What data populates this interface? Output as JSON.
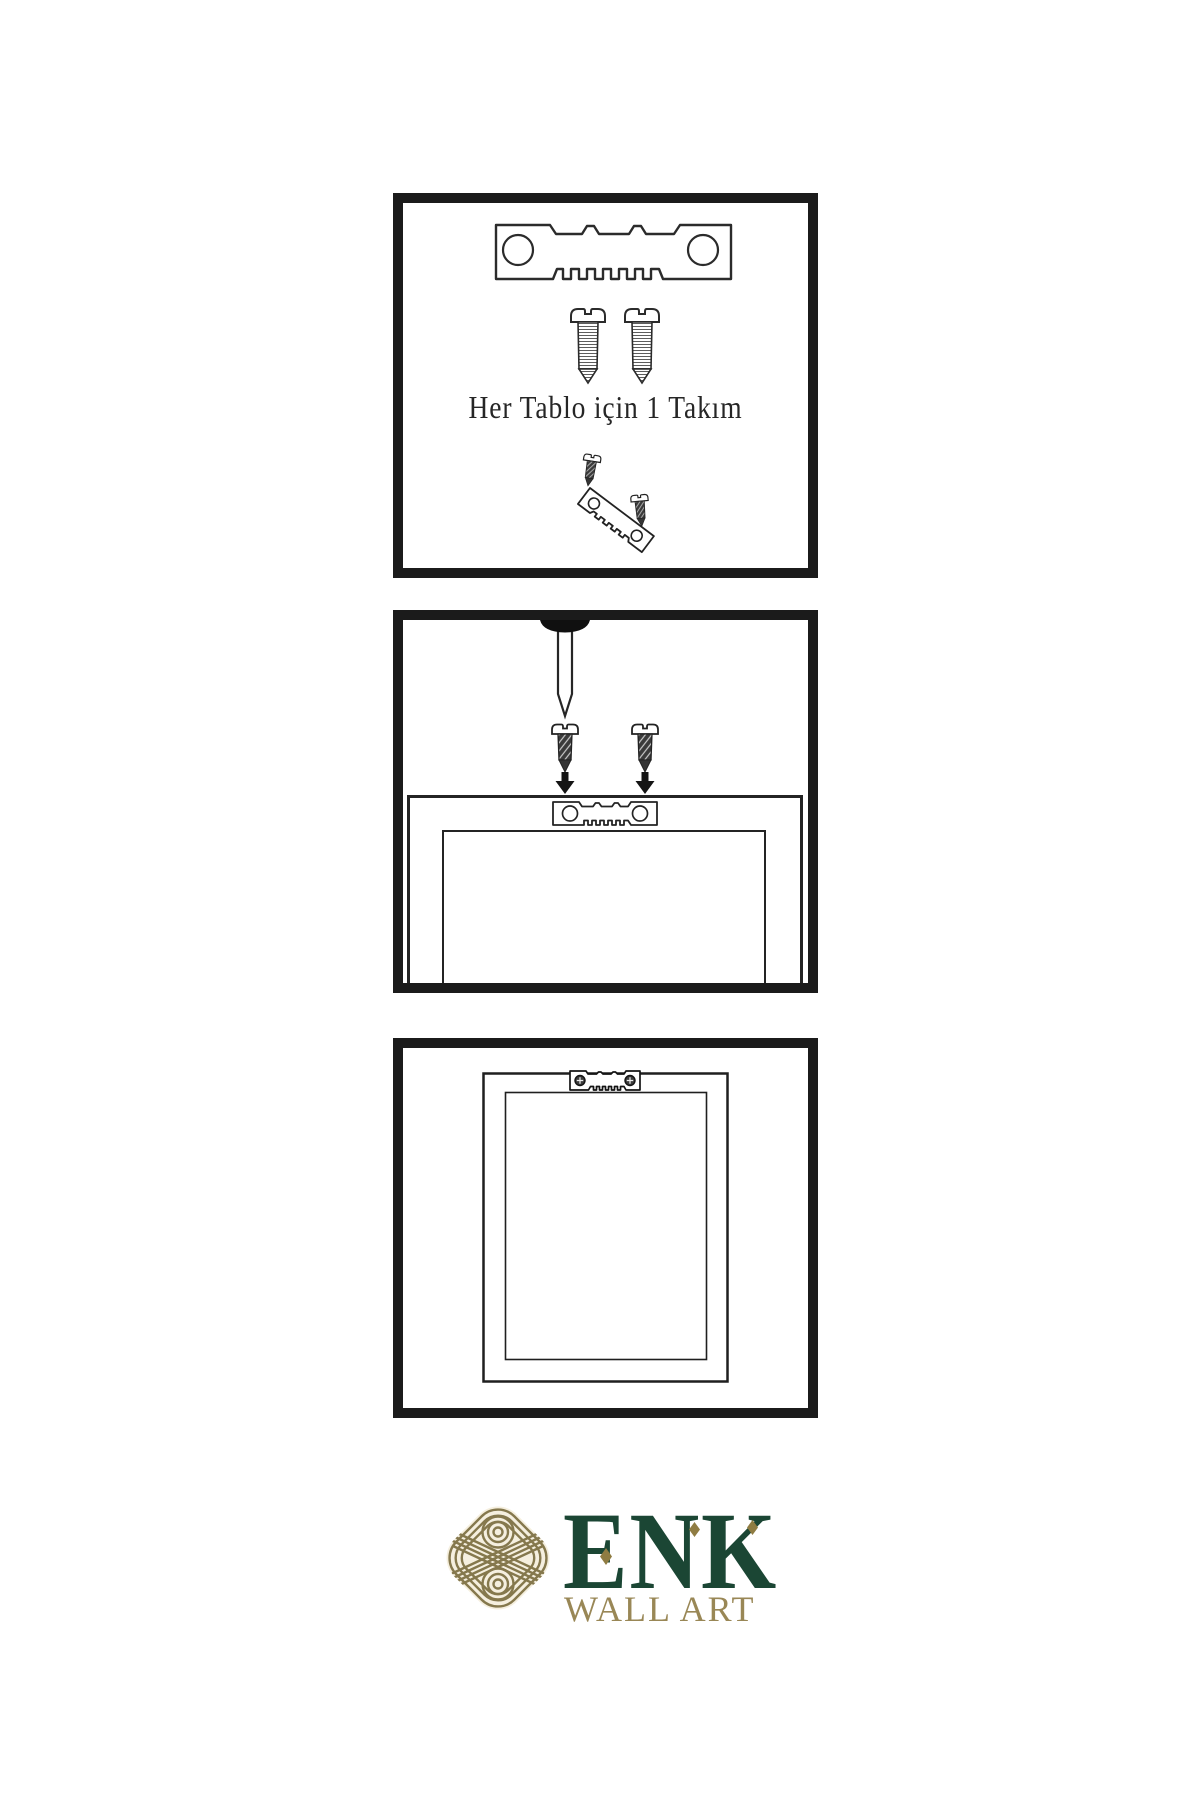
{
  "page": {
    "background": "#ffffff",
    "ink": "#222222"
  },
  "instructions": {
    "step1": {
      "caption": "Her Tablo için 1 Takım",
      "icons": [
        "sawtooth-hanger-icon",
        "screw-icon",
        "screw-icon",
        "hanger-assembly-icon"
      ]
    },
    "step2": {
      "icons": [
        "wall-nail-icon",
        "screw-icon",
        "screw-icon",
        "down-arrow-icon",
        "frame-with-sawtooth-hanger-icon"
      ]
    },
    "step3": {
      "icons": [
        "hung-frame-icon",
        "mounted-sawtooth-hanger-icon"
      ]
    }
  },
  "brand": {
    "name": "ENK",
    "tagline": "WALL ART",
    "logo_icon": "interlaced-knot-icon",
    "colors": {
      "knot": "#85784d",
      "knot_background": "#f5efdf",
      "name": "#1b4634",
      "tagline": "#998756",
      "accent_diamond": "#8f7c42"
    }
  }
}
